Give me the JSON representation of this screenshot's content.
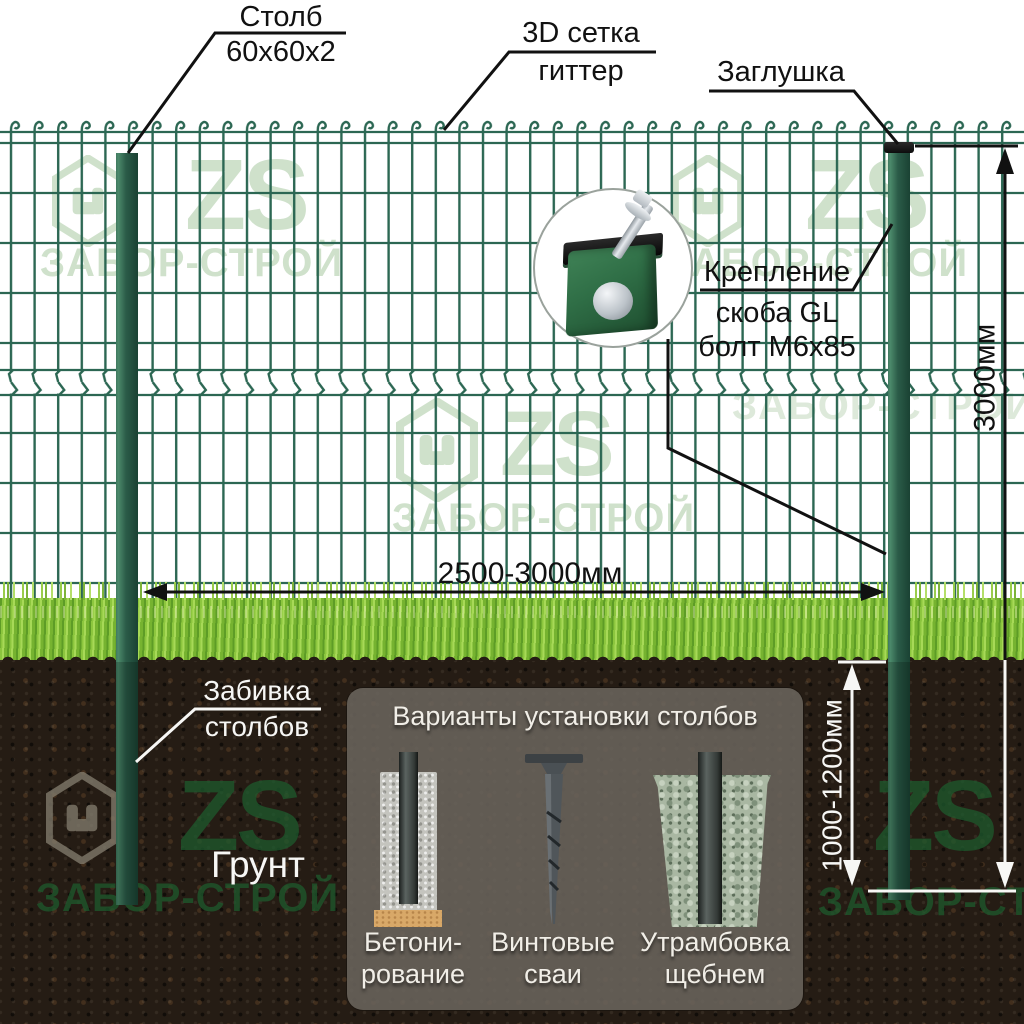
{
  "labels": {
    "post": {
      "title": "Столб",
      "size": "60x60x2"
    },
    "mesh": {
      "line1": "3D сетка",
      "line2": "гиттер"
    },
    "cap": "Заглушка",
    "fastener": {
      "title": "Крепление",
      "line1": "скоба GL",
      "line2": "болт M6x85"
    },
    "driving": {
      "line1": "Забивка",
      "line2": "столбов"
    },
    "ground": "Грунт"
  },
  "dimensions": {
    "span": "2500-3000мм",
    "height": "3000мм",
    "depth": "1000-1200мм"
  },
  "options_panel": {
    "title": "Варианты установки столбов",
    "options": [
      {
        "line1": "Бетони-",
        "line2": "рование"
      },
      {
        "line1": "Винтовые",
        "line2": "сваи"
      },
      {
        "line1": "Утрамбовка",
        "line2": "щебнем"
      }
    ]
  },
  "watermark": {
    "logo": "ZS",
    "brand": "ЗАБОР-СТРОЙ"
  },
  "colors": {
    "mesh_wire": "#2c6753",
    "post_green": "#2d5f4b",
    "cap_black": "#111111",
    "annotation_black": "#111111",
    "annotation_white": "#f7f7f5",
    "grass_green": "#8cc63e",
    "soil_brown": "#251c14",
    "watermark_light": "#c7dcc3",
    "watermark_dark": "#1d5a2d",
    "panel_gray": "rgba(106,100,92,0.88)",
    "clamp_green": "#2f6e46"
  }
}
